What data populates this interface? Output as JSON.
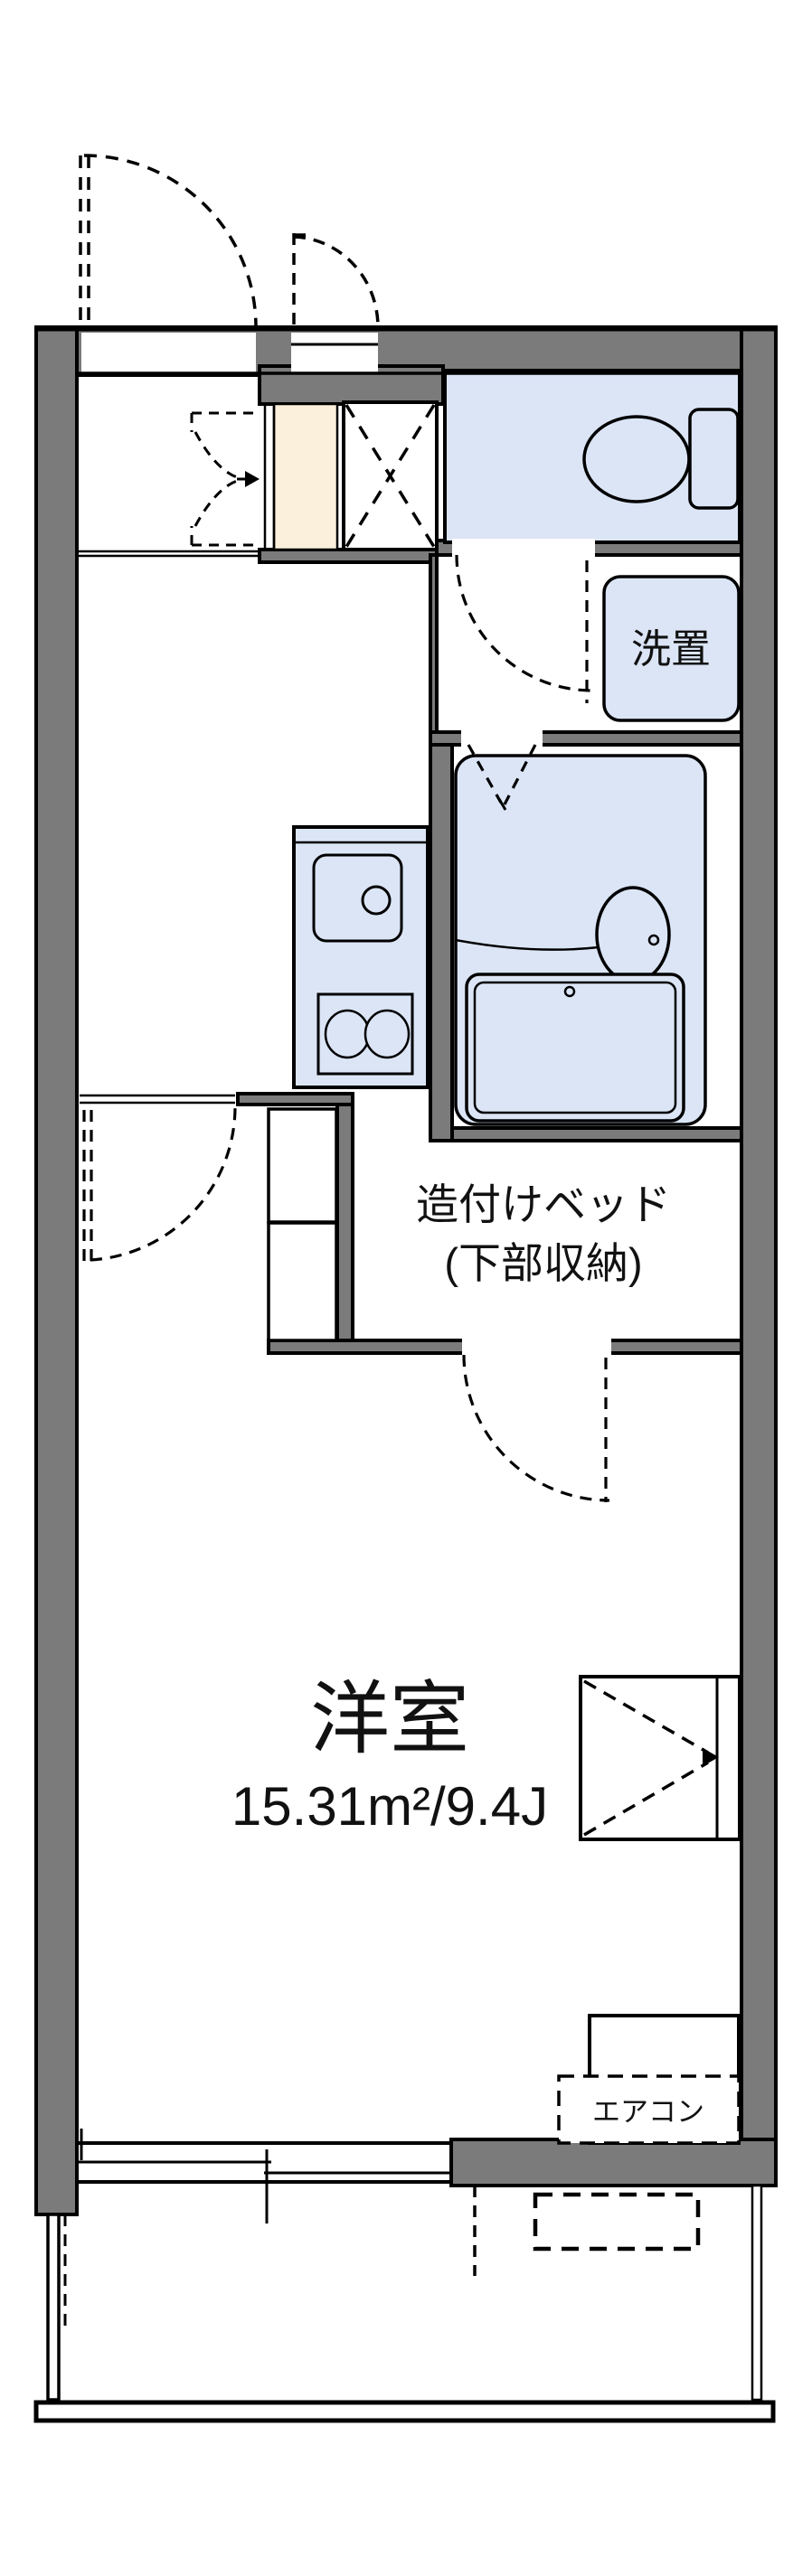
{
  "floorplan": {
    "labels": {
      "main_room_name": "洋室",
      "main_room_area": "15.31m²/9.4J",
      "bed_line1": "造付けベッド",
      "bed_line2": "(下部収納)",
      "washer_space": "洗置",
      "air_conditioner": "エアコン"
    },
    "colors": {
      "wall_gray": "#7b7b7b",
      "fixture_blue": "#dbe5f6",
      "entrance_cream": "#faf0dc",
      "line_black": "#000000",
      "background": "#ffffff"
    }
  }
}
